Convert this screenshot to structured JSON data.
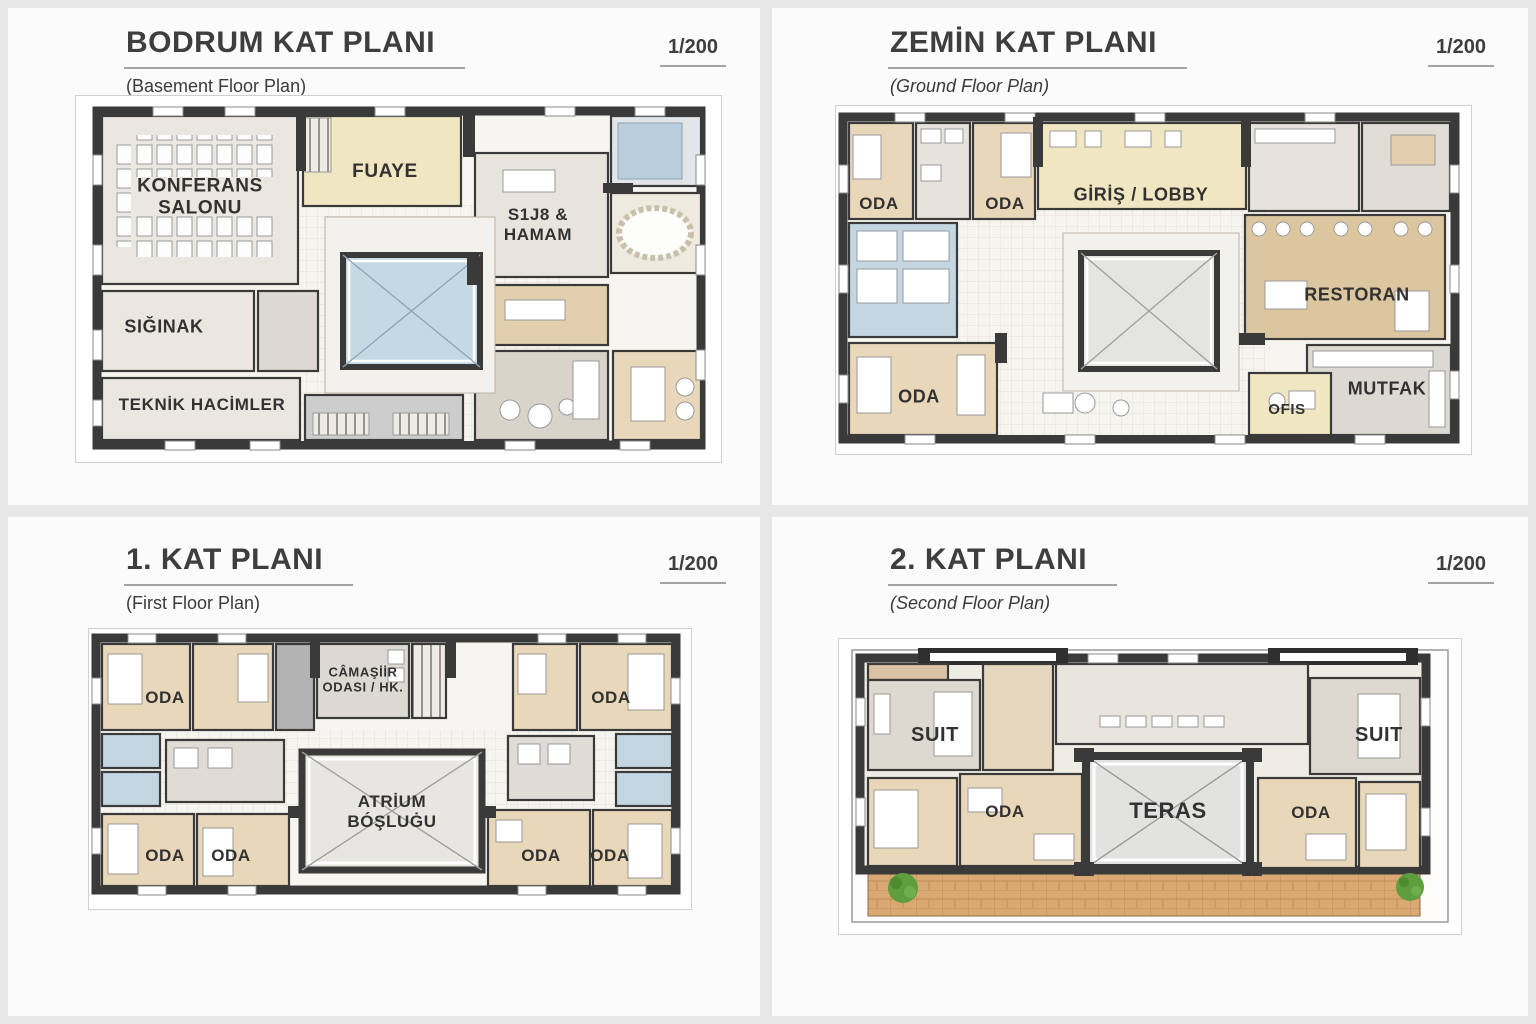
{
  "panels": [
    {
      "title": "BODRUM KAT PLANI",
      "subtitle": "(Basement Floor Plan)",
      "scale": "1/200",
      "rooms": {
        "konferans": "KONFERANS\nSALONU",
        "fuaye": "FUAYE",
        "spa_hamam": "S1J8 &\nHAMAM",
        "siginak": "SIĞINAK",
        "teknik": "TEKNİK HACİMLER"
      }
    },
    {
      "title": "ZEMİN KAT PLANI",
      "subtitle": "(Ground Floor Plan)",
      "scale": "1/200",
      "rooms": {
        "oda_1": "ODA",
        "oda_2": "ODA",
        "giris_lobby": "GİRİŞ / LOBBY",
        "restoran": "RESTORAN",
        "oda_3": "ODA",
        "ofis": "OFIS",
        "mutfak": "MUTFAK"
      }
    },
    {
      "title": "1. KAT PLANI",
      "subtitle": "(First Floor Plan)",
      "scale": "1/200",
      "rooms": {
        "oda_tl": "ODA",
        "camasir": "CÂMAŞİİR\nODASI / HK.",
        "oda_tr": "ODA",
        "atrium": "ATRİUM\nBÓŞLUĠU",
        "oda_bl1": "ODA",
        "oda_bl2": "ODA",
        "oda_br1": "ODA",
        "oda_br2": "ODA"
      }
    },
    {
      "title": "2. KAT PLANI",
      "subtitle": "(Second Floor Plan)",
      "scale": "1/200",
      "rooms": {
        "suit_l": "SUIT",
        "suit_r": "SUIT",
        "oda_l": "ODA",
        "oda_r": "ODA",
        "teras": "TERAS"
      }
    }
  ],
  "palette": {
    "wall": "#3a3a3a",
    "room_beige": "#e9d7ba",
    "room_cream": "#f0e6c2",
    "room_tan": "#dcc69f",
    "room_gray": "#e7e4dd",
    "bath_blue": "#c3d6e2",
    "courtyard_blue": "#c5d9e5",
    "wood_deck": "#d9a873",
    "tree_green": "#5f9e3e",
    "page_bg": "#e7e7e7",
    "panel_bg": "#fbfbfb"
  }
}
